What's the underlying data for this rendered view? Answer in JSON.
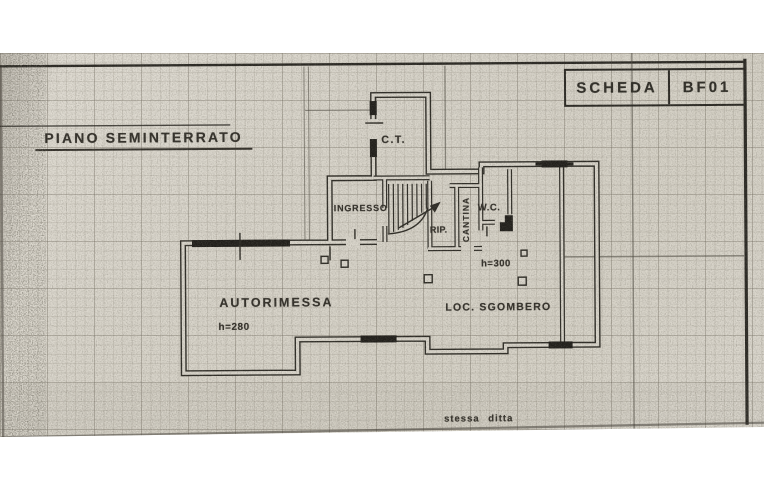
{
  "sheet": {
    "card_label": "SCHEDA",
    "card_code": "BF01",
    "title": "PIANO SEMINTERRATO",
    "footer_note": "stessa ditta"
  },
  "rooms": {
    "boiler_room": "C.T.",
    "entrance": "INGRESSO",
    "closet": "RIP.",
    "cellar": "CANTINA",
    "wc": "W.C.",
    "garage": "AUTORIMESSA",
    "garage_height": "h=280",
    "storage": "LOC. SGOMBERO",
    "storage_height": "h=300"
  },
  "colors": {
    "paper": "#d9d5cb",
    "ink": "#2e2c26"
  }
}
